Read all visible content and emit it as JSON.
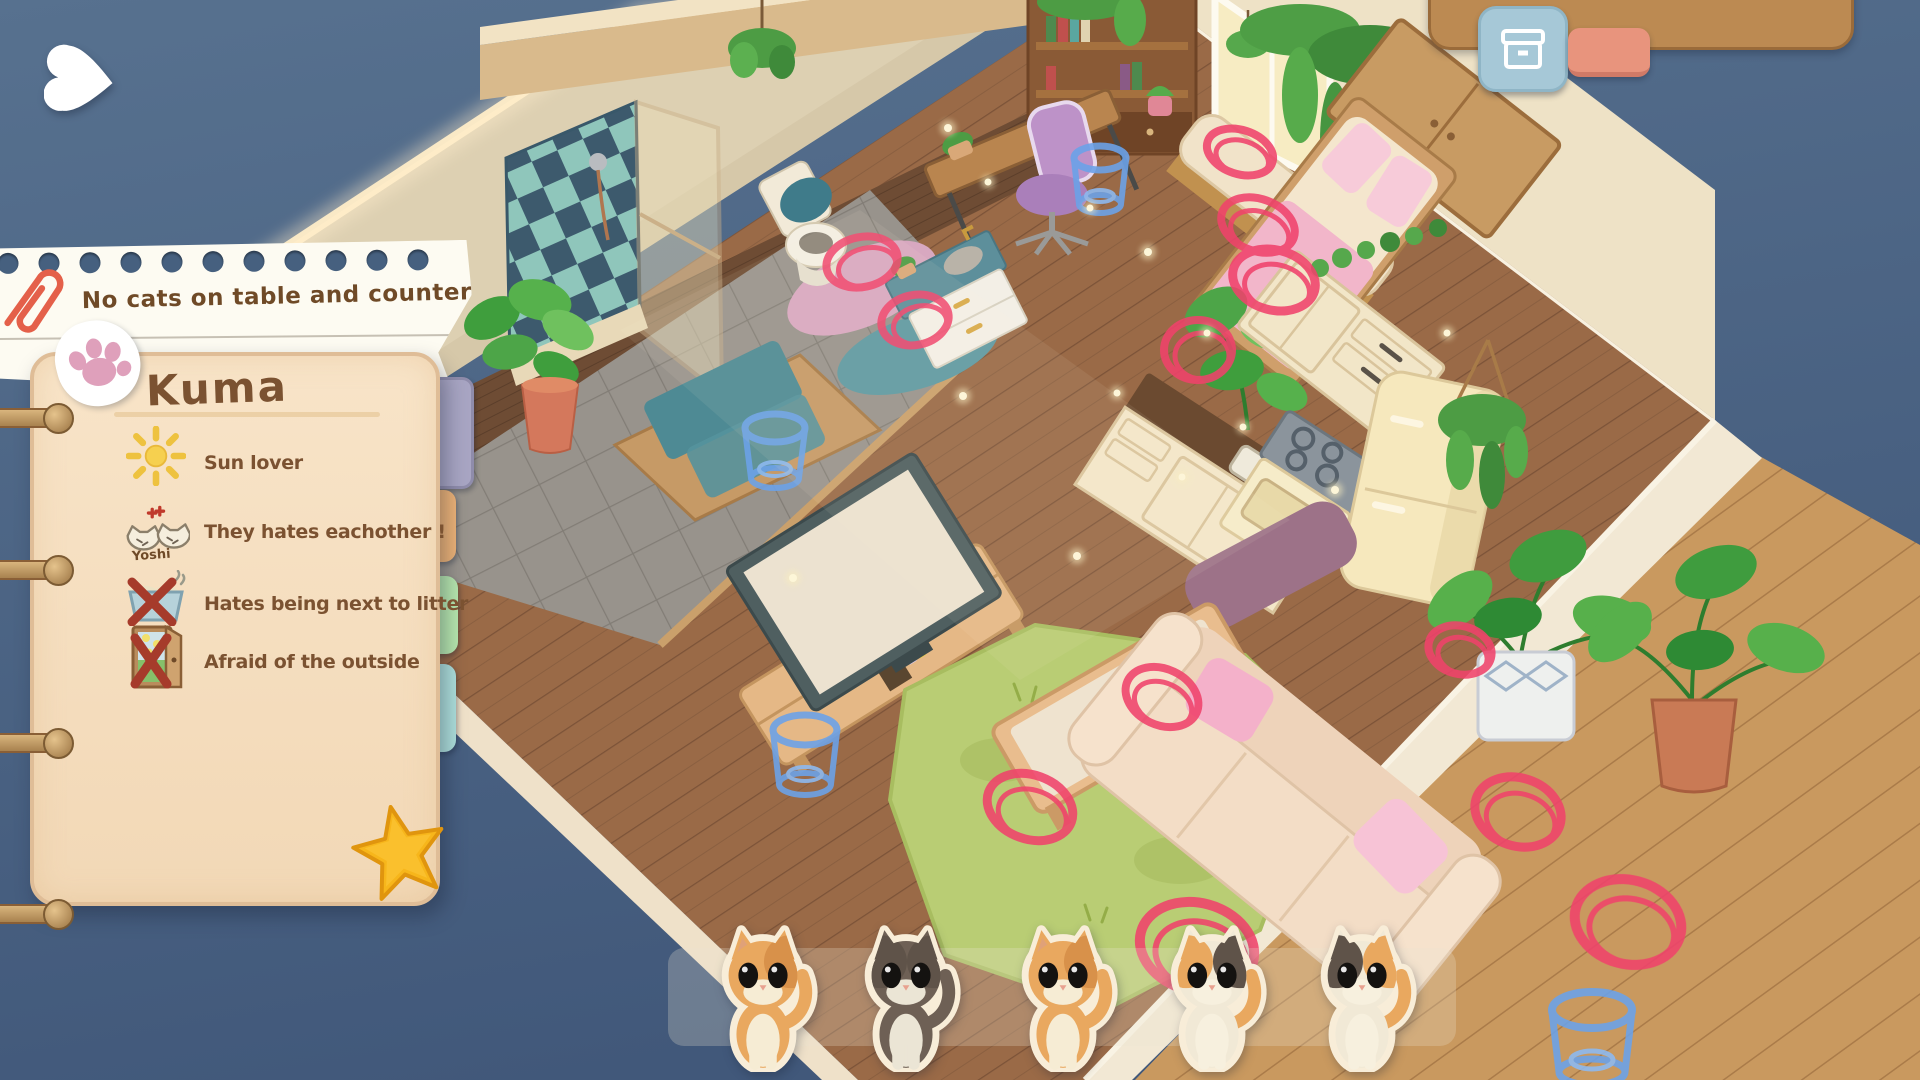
{
  "ui": {
    "back_button": {
      "icon": "heart-back-icon",
      "color": "#ffffff"
    },
    "top_right_panel": {
      "color": "#bc8a52"
    },
    "storage_button": {
      "icon": "storage-box-icon",
      "color": "#a6c8d7"
    },
    "secondary_button": {
      "color": "#e8947d"
    }
  },
  "notepad": {
    "rule_note": "No cats on table and counters !",
    "cat_name": "Kuma",
    "traits": [
      {
        "icon": "sun-icon",
        "label": "Sun lover"
      },
      {
        "icon": "angry-cats-icon",
        "label": "They hates eachother !",
        "sub_label": "Yoshi"
      },
      {
        "icon": "crossed-litter-box-icon",
        "label": "Hates being next to litter"
      },
      {
        "icon": "crossed-door-icon",
        "label": "Afraid of the outside"
      }
    ],
    "tabs": [
      {
        "id": "tab-purple",
        "color": "#a8a5c3"
      },
      {
        "id": "tab-orange",
        "color": "#edb377"
      },
      {
        "id": "tab-green",
        "color": "#b7e7ae"
      },
      {
        "id": "tab-blue",
        "color": "#aee0dc"
      }
    ],
    "stickers": {
      "paw_color": "#dfa0bb",
      "star_color": "#f7b61b",
      "paperclip_color": "#e4604a"
    }
  },
  "cat_tray": {
    "cats": [
      {
        "id": "cat-1",
        "pattern": "orange-tabby",
        "colors": {
          "fur": "#e9a85f",
          "chest": "#f6ecd4",
          "patchL": "transparent",
          "patchR": "#d8914a",
          "tail": "#e9a85f"
        }
      },
      {
        "id": "cat-2",
        "pattern": "brown-tuxedo",
        "colors": {
          "fur": "#6e6055",
          "chest": "#ebe5d5",
          "patchL": "#5f5349",
          "patchR": "#5f5349",
          "tail": "#6e6055"
        }
      },
      {
        "id": "cat-3",
        "pattern": "orange-tabby",
        "colors": {
          "fur": "#e9a85f",
          "chest": "#f6ecd4",
          "patchL": "transparent",
          "patchR": "#d8914a",
          "tail": "#e9a85f"
        }
      },
      {
        "id": "cat-4",
        "pattern": "calico",
        "colors": {
          "fur": "#f1e9d6",
          "chest": "#f7f0de",
          "patchL": "#e9a85f",
          "patchR": "#5f5349",
          "tail": "#e9a85f"
        }
      },
      {
        "id": "cat-5",
        "pattern": "calico",
        "colors": {
          "fur": "#f1e9d6",
          "chest": "#f7f0de",
          "patchL": "#5f5349",
          "patchR": "#e9a85f",
          "tail": "#e9a85f"
        }
      }
    ]
  },
  "scene": {
    "markers": {
      "red_ring_color": "#f0436b",
      "blue_ring_color": "#6ba2e8",
      "red_ring_count": 12,
      "blue_ring_count": 4
    },
    "palette": {
      "background_top": "#56708f",
      "background_bottom": "#41587a",
      "floor_wood": "#9a6a47",
      "deck_wood": "#c9995f",
      "bathroom_tile": "#98938c",
      "wall": "#ddd0b2",
      "accent_teal": "#4e8a94",
      "rug_green": "#b9cd74",
      "sofa_cream": "#f3ddc6",
      "pillow_pink": "#f4b1ca"
    }
  }
}
